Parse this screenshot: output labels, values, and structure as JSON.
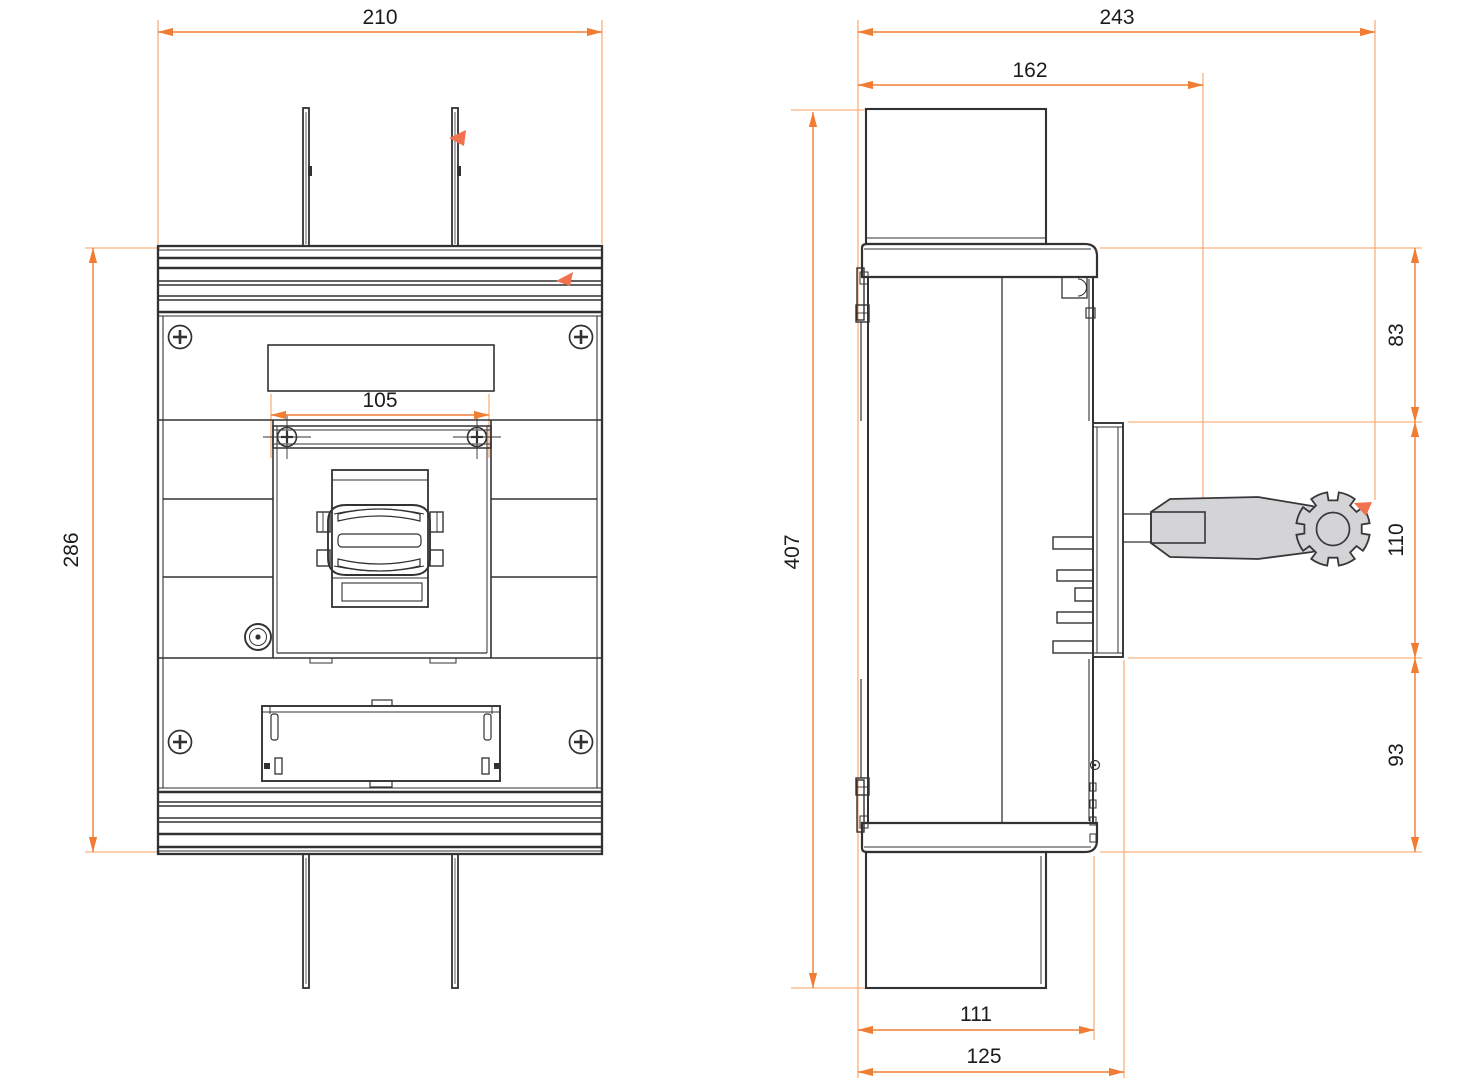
{
  "drawing": {
    "colors": {
      "dimension_line": "#F07D33",
      "extension_line": "#F5A263",
      "marker_arrow": "#F2714E",
      "outline": "#323234",
      "lever_fill": "#D4D4D6"
    },
    "front_view": {
      "dimensions": {
        "overall_width": "210",
        "overall_height": "286",
        "handle_mount_width": "105"
      }
    },
    "side_view": {
      "dimensions": {
        "overall_depth": "243",
        "body_depth": "162",
        "overall_height": "407",
        "upper_section_height": "83",
        "handle_section_height": "110",
        "lower_section_height": "93",
        "body_front_depth": "111",
        "handle_plate_depth": "125"
      }
    }
  }
}
